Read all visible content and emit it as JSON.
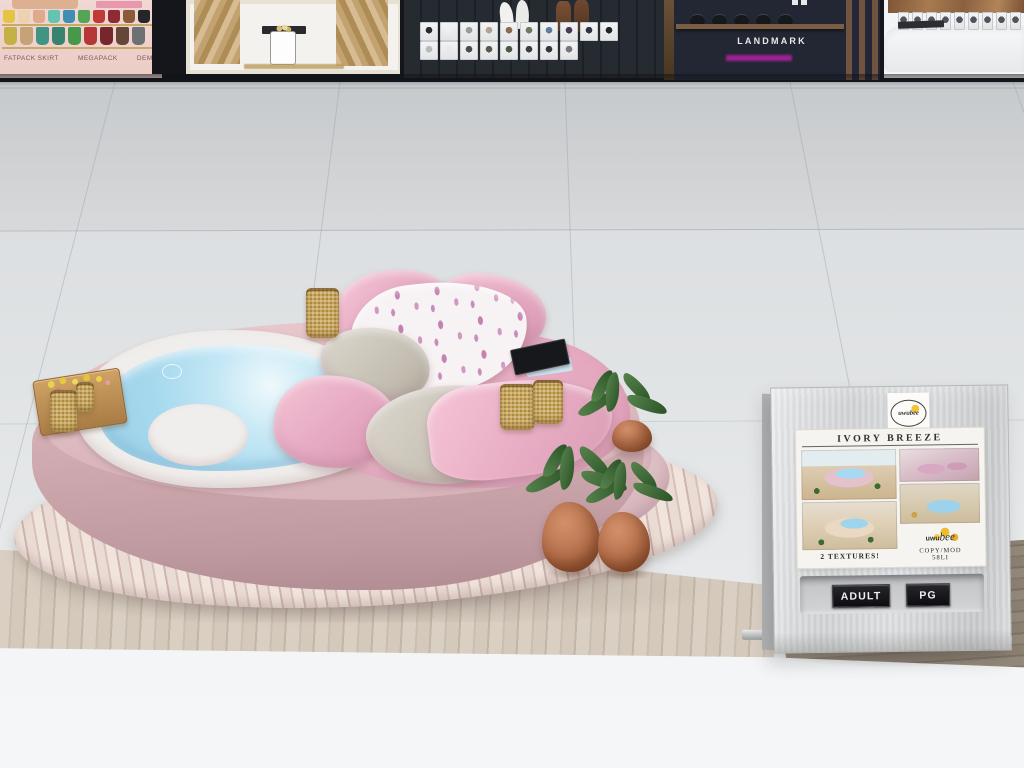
{
  "scene_label": "virtual world furniture shop floor",
  "stores": {
    "fashion": {
      "labels": [
        "FATPACK SKIRT",
        "MEGAPACK",
        "DEMO"
      ],
      "top_colors": [
        "#e5c343",
        "#ecd3ad",
        "#dfa98c",
        "#63c4b2",
        "#3f8fb5",
        "#55a556",
        "#c23a38",
        "#8e2b33",
        "#8a5a3a",
        "#26262a"
      ],
      "skirt_colors": [
        "#c3b148",
        "#c6a277",
        "#3f9484",
        "#37836f",
        "#47984a",
        "#b53736",
        "#77262e",
        "#664637",
        "#6f7074"
      ]
    },
    "boutique": {
      "shirt_colors": [
        "#2b2b2f",
        "#f0efec",
        "#9c9c98",
        "#b5a28e",
        "#8a6a50",
        "#6e7a5e",
        "#5f7e9e",
        "#4a3a52",
        "#303440",
        "#222428"
      ],
      "pants_colors": [
        "#b8b9ba",
        "#ece9e4",
        "#4a4c50",
        "#5e5850",
        "#4e5846",
        "#3c3e44",
        "#35373b",
        "#75777b"
      ]
    },
    "landmark": {
      "title": "LANDMARK",
      "pot_colors": [
        "#16181e",
        "#16181e",
        "#16181e",
        "#16181e",
        "#16181e"
      ]
    },
    "counter": {
      "card_colors": [
        "#55525e",
        "#55525e",
        "#55525e",
        "#55525e",
        "#55525e",
        "#55525e",
        "#55525e",
        "#55525e",
        "#55525e",
        "#55525e"
      ]
    }
  },
  "vendor": {
    "brand": "uwubee",
    "brand_prefix": "uwu",
    "brand_suffix": "bee",
    "poster_title": "IVORY BREEZE",
    "note": "2 TEXTURES!",
    "permissions": "COPY/MOD",
    "land_impact": "58LI",
    "buttons": [
      {
        "label": "ADULT"
      },
      {
        "label": "PG"
      }
    ]
  },
  "palette": {
    "product_pink": "#d4aeb3",
    "water_blue": "#aadcee",
    "deck_wood": "#e6d4cd",
    "floor_tile": "#e2e4e6",
    "kiosk_metal": "#d6d8da",
    "button_black": "#121216",
    "landmark_accent": "#b122a6",
    "honey_yellow": "#f0be1e"
  }
}
